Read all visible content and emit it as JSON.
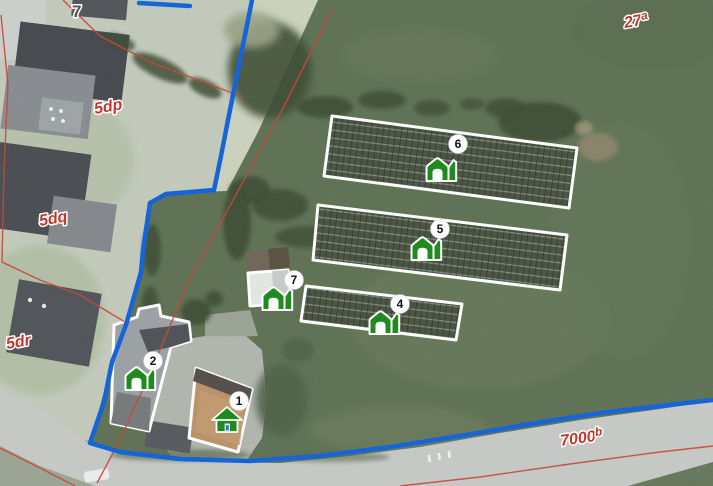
{
  "map": {
    "type": "aerial-cadastral-map",
    "colors": {
      "boundary_blue": "#1565d8",
      "cadastral_red": "#c9473b",
      "label_red": "#c03a30",
      "label_gray": "#57534e",
      "marker_green": "#1f8b1f",
      "building_outline_white": "#ffffff"
    },
    "labels": {
      "house_number": {
        "text": "7"
      },
      "parcels": [
        {
          "text": "5dp"
        },
        {
          "text": "5dq"
        },
        {
          "text": "5dr"
        }
      ],
      "parcel_27a": {
        "base": "27",
        "sup": "a"
      },
      "parcel_7000b": {
        "base": "7000",
        "sup": "b"
      }
    },
    "markers": [
      {
        "number": "1",
        "icon": "house-icon"
      },
      {
        "number": "2",
        "icon": "barn-icon"
      },
      {
        "number": "4",
        "icon": "barn-icon"
      },
      {
        "number": "5",
        "icon": "barn-icon"
      },
      {
        "number": "6",
        "icon": "barn-icon"
      },
      {
        "number": "7",
        "icon": "barn-icon"
      }
    ]
  }
}
